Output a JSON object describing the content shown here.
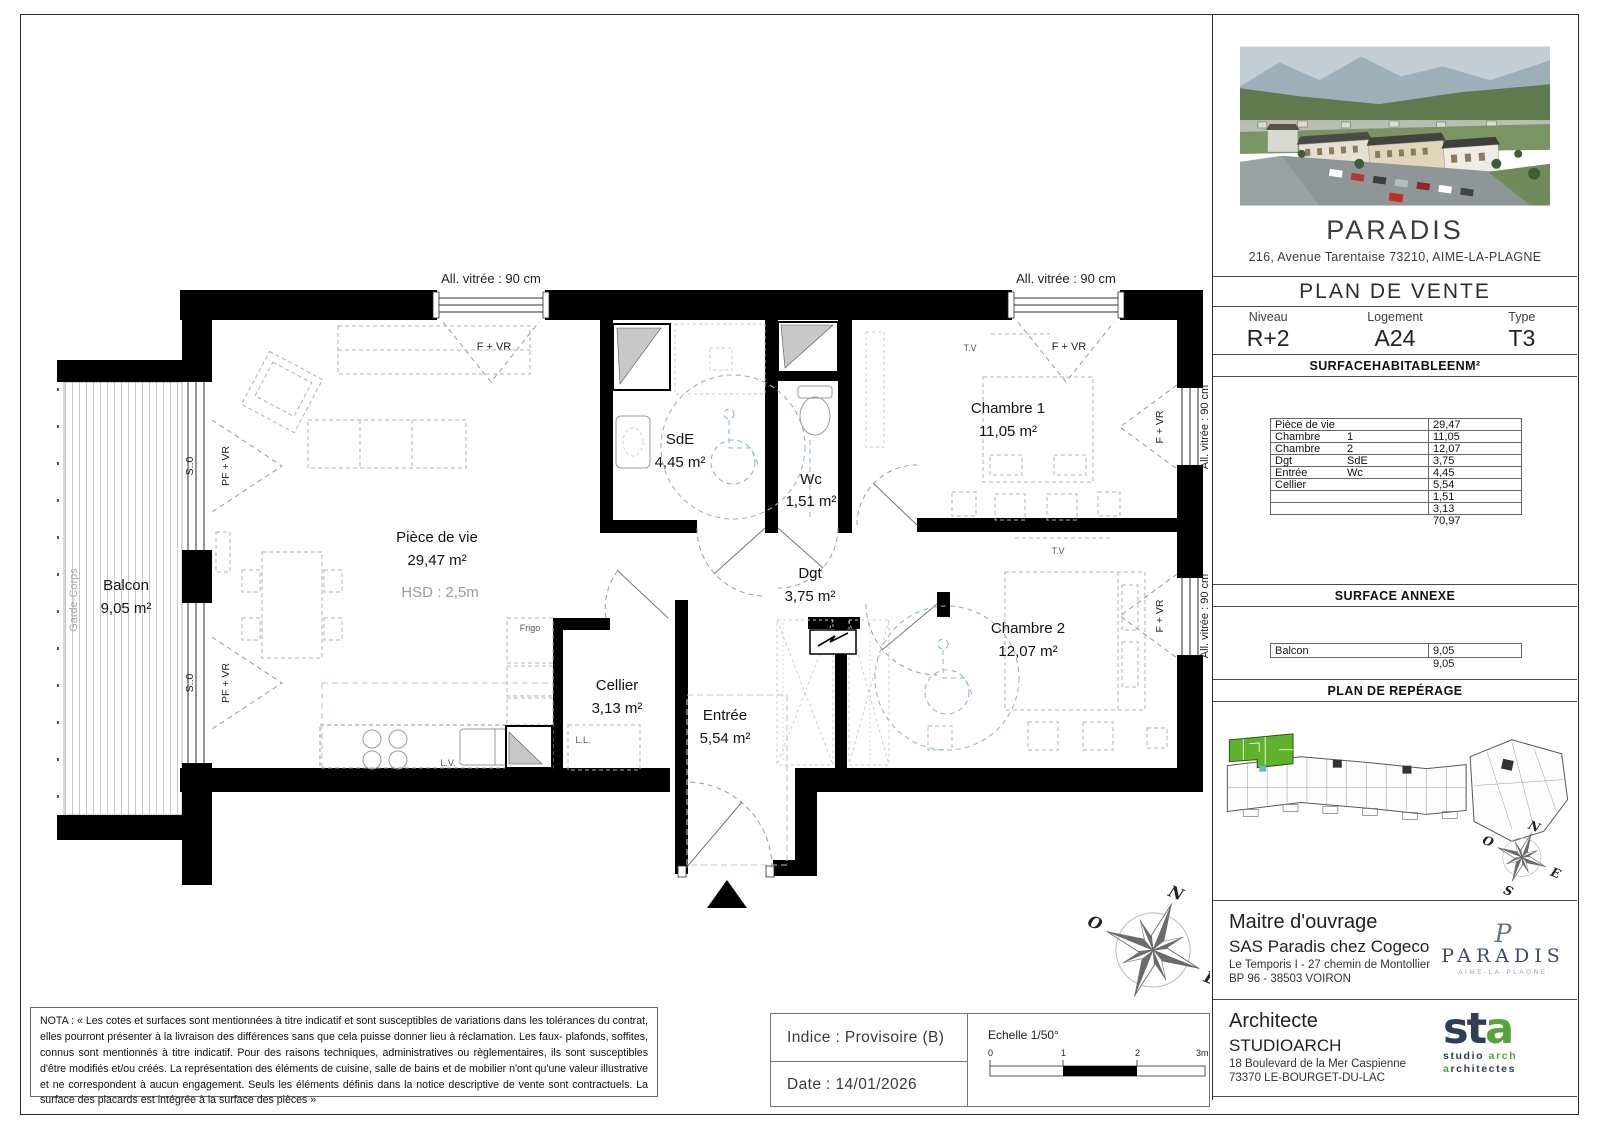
{
  "colors": {
    "wall": "#000000",
    "highlight_green": "#5fb32c",
    "logo_navy": "#2e3f54",
    "logo_green": "#55a43a",
    "paradis_slate": "#3d4d63",
    "wheelchair_blue": "#8fb9c9",
    "zone_teal": "#a9cdd6"
  },
  "sidebar": {
    "project": {
      "name": "PARADIS",
      "address": "216, Avenue Tarentaise 73210, AIME-LA-PLAGNE"
    },
    "doc_title": "PLAN DE VENTE",
    "meta": {
      "niveau_label": "Niveau",
      "niveau": "R+2",
      "logement_label": "Logement",
      "logement": "A24",
      "type_label": "Type",
      "type": "T3"
    },
    "surface_table": {
      "title": "SURFACEHABITABLEENM²",
      "rows": [
        {
          "label": "Pièce de vie",
          "label2": "",
          "value": "29,47"
        },
        {
          "label": "Chambre",
          "label2": "1",
          "value": "11,05"
        },
        {
          "label": "Chambre",
          "label2": "2",
          "value": "12,07"
        },
        {
          "label": "Dgt",
          "label2": "SdE",
          "value": "3,75"
        },
        {
          "label": "Entrée",
          "label2": "Wc",
          "value": "4,45"
        },
        {
          "label": "Cellier",
          "label2": "",
          "value": "5,54"
        },
        {
          "label": "",
          "label2": "",
          "value": "1,51"
        },
        {
          "label": "",
          "label2": "",
          "value": "3,13"
        }
      ],
      "total": "70,97"
    },
    "surface_annexe": {
      "title": "SURFACE ANNEXE",
      "rows": [
        {
          "label": "Balcon",
          "value": "9,05"
        }
      ],
      "total": "9,05"
    },
    "reperage_title": "PLAN DE REPÉRAGE",
    "maitre": {
      "title": "Maitre d'ouvrage",
      "name": "SAS Paradis chez Cogeco",
      "line1": "Le Temporis I - 27 chemin de Montollier",
      "line2": "BP 96 - 38503 VOIRON",
      "logo_monogram": "P",
      "logo_name": "PARADIS",
      "logo_sub": "AIME-LA-PLAGNE"
    },
    "architecte": {
      "title": "Architecte",
      "name": "STUDIOARCH",
      "line1": "18 Boulevard de la Mer Caspienne",
      "line2": "73370 LE-BOURGET-DU-LAC",
      "logo_st": "st",
      "logo_a": "a",
      "logo_line1_a": "studio ",
      "logo_line1_b": "arch",
      "logo_line2_a": "a",
      "logo_line2_b": "rchitectes"
    }
  },
  "footer": {
    "nota": "NOTA : « Les cotes et surfaces sont mentionnées à titre indicatif et sont susceptibles de variations dans les tolérances du contrat, elles pourront présenter à la livraison des différences sans que cela puisse donner lieu à réclamation. Les faux- plafonds, soffites, connus sont mentionnés à titre indicatif. Pour des raisons techniques, administratives ou règlementaires, ils sont susceptibles d'être modifiés et/ou créés. La représentation des éléments de cuisine, salle de bains et de mobilier n'ont qu'une valeur illustrative et ne correspondent à aucun engagement. Seuls les éléments définis dans la notice descriptive de vente sont contractuels. La surface des placards est intégrée à la surface des pièces »",
    "indice": "Indice : Provisoire (B)",
    "date": "Date : 14/01/2026",
    "echelle": "Echelle 1/50°",
    "scale_ticks": [
      "0",
      "1",
      "2",
      "3m"
    ]
  },
  "plan": {
    "rooms": {
      "piece_de_vie": {
        "name": "Pièce de vie",
        "area": "29,47 m²"
      },
      "chambre1": {
        "name": "Chambre 1",
        "area": "11,05 m²"
      },
      "chambre2": {
        "name": "Chambre 2",
        "area": "12,07 m²"
      },
      "sde": {
        "name": "SdE",
        "area": "4,45 m²"
      },
      "wcr": {
        "name": "Wc",
        "area": "1,51 m²"
      },
      "dgt": {
        "name": "Dgt",
        "area": "3,75 m²"
      },
      "cellier": {
        "name": "Cellier",
        "area": "3,13 m²"
      },
      "entree": {
        "name": "Entrée",
        "area": "5,54 m²"
      },
      "balcon": {
        "name": "Balcon",
        "area": "9,05 m²"
      }
    },
    "labels": {
      "hsd": "HSD : 2,5m",
      "garde_corps": "Garde-Corps",
      "all_vitree": "All. vitrée : 90 cm",
      "f_vr": "F + VR",
      "pf_vr": "PF + VR",
      "s0": "S.:0",
      "tv": "T.V",
      "frigo": "Frigo",
      "ll": "L.L.",
      "lv": "L.V."
    },
    "compass": {
      "n": "N",
      "s": "S",
      "e": "E",
      "o": "O"
    }
  }
}
